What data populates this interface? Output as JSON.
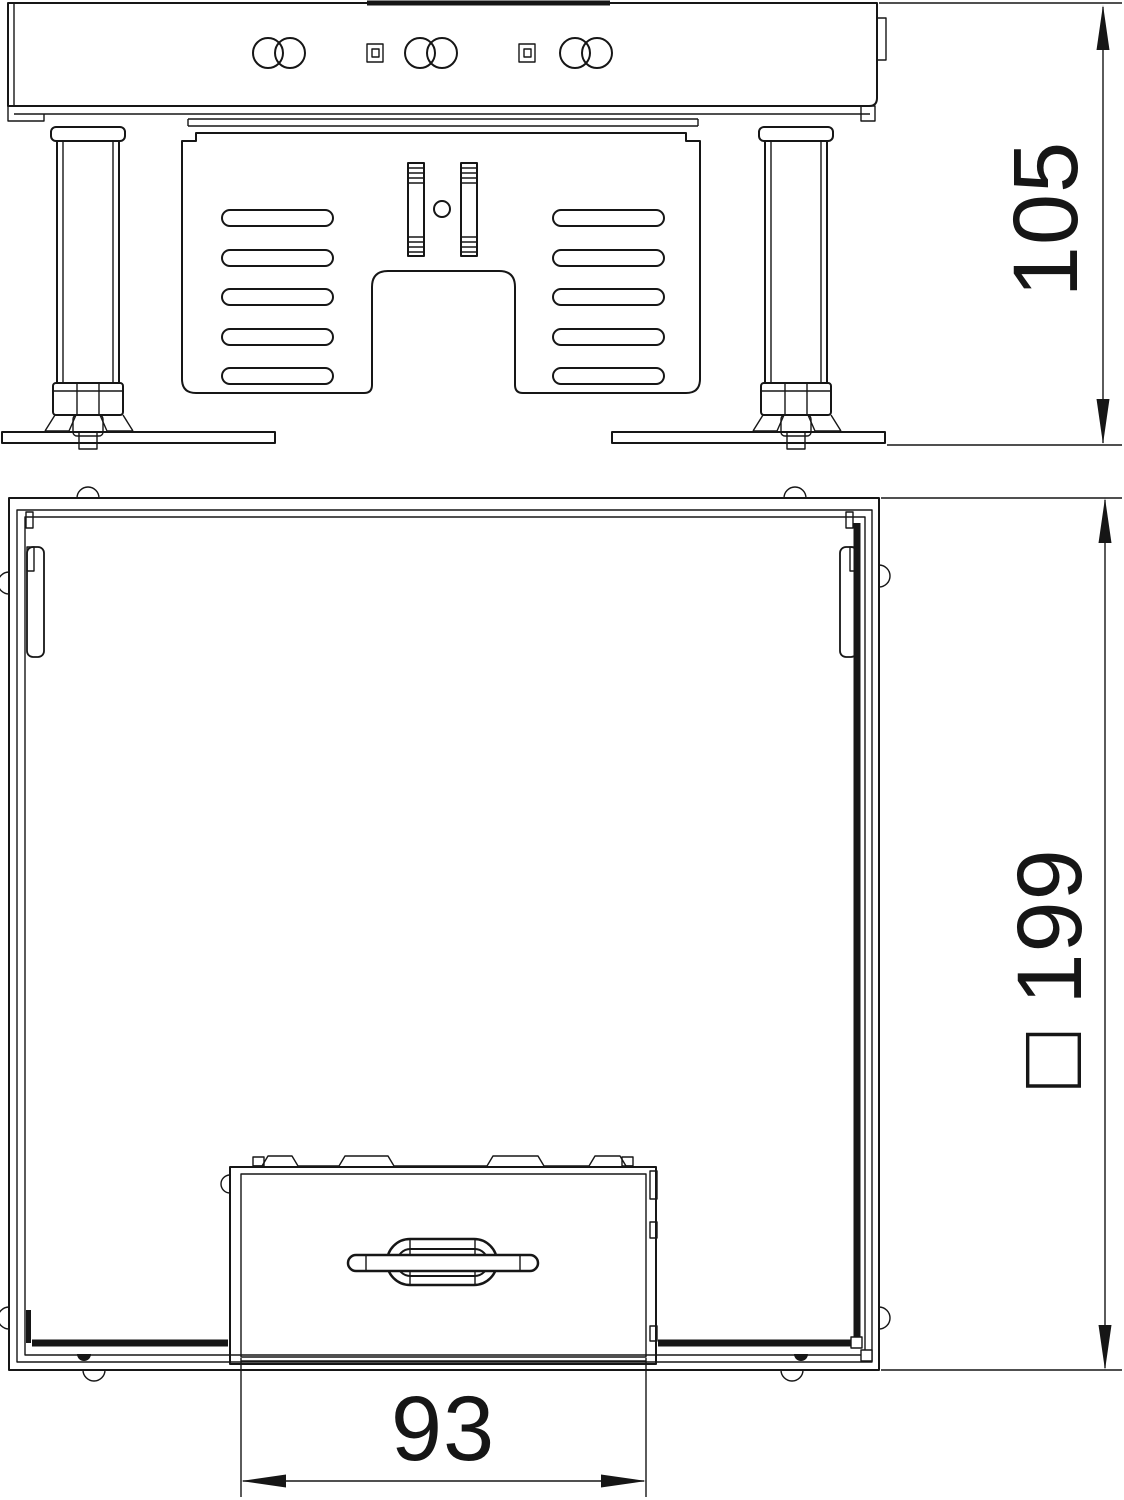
{
  "drawing": {
    "kind": "technical-drawing-floor-box",
    "background": "#ffffff",
    "line_color": "#161616",
    "views": {
      "side": {
        "id": "side-elevation-view"
      },
      "plan": {
        "id": "plan-view"
      }
    },
    "dimensions": {
      "height": {
        "value": "105",
        "label": "105",
        "orientation": "vertical"
      },
      "outer": {
        "value": "199",
        "symbol": "□",
        "label": "□ 199",
        "orientation": "vertical"
      },
      "cassette": {
        "value": "93",
        "label": "93",
        "orientation": "horizontal"
      }
    }
  }
}
